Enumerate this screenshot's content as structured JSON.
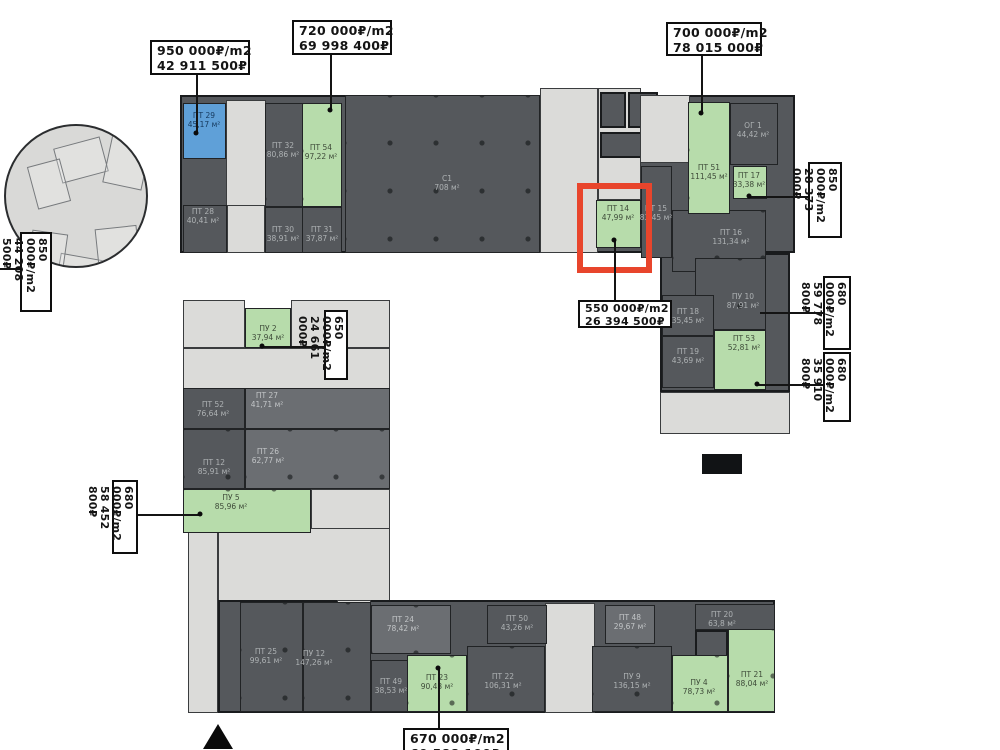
{
  "canvas": {
    "width": 1000,
    "height": 750,
    "background": "#ffffff"
  },
  "palette": {
    "dark": "#55585c",
    "mid": "#6b6e72",
    "light": "#dbdbd9",
    "green": "#b7dcab",
    "blue": "#5fa0d8",
    "red": "#e8452c"
  },
  "units": [
    {
      "name": "ПТ 29",
      "area": "45,17 м²",
      "type": "blue",
      "rect": [
        183,
        103,
        43,
        56
      ],
      "label": [
        204,
        120
      ],
      "dots": false
    },
    {
      "name": "ПТ 32",
      "area": "80,86 м²",
      "type": "dark",
      "rect": [
        265,
        103,
        38,
        104
      ],
      "label": [
        283,
        150
      ],
      "dots": true
    },
    {
      "name": "ПТ 54",
      "area": "97,22 м²",
      "type": "green",
      "rect": [
        302,
        103,
        40,
        104
      ],
      "label": [
        321,
        152
      ],
      "dots": true
    },
    {
      "name": "ПТ 28",
      "area": "40,41 м²",
      "type": "dark",
      "rect": [
        183,
        205,
        44,
        48
      ],
      "label": [
        203,
        216
      ],
      "dots": false
    },
    {
      "name": "ПТ 30",
      "area": "38,91 м²",
      "type": "dark",
      "rect": [
        265,
        207,
        38,
        46
      ],
      "label": [
        283,
        234
      ],
      "dots": false
    },
    {
      "name": "ПТ 31",
      "area": "37,87 м²",
      "type": "dark",
      "rect": [
        302,
        207,
        40,
        46
      ],
      "label": [
        322,
        234
      ],
      "dots": false
    },
    {
      "name": "C1",
      "area": "708 м²",
      "type": "dark",
      "rect": [
        345,
        95,
        195,
        158
      ],
      "label": [
        447,
        183
      ],
      "dots": true
    },
    {
      "name": "ПТ 14",
      "area": "47,99 м²",
      "type": "green",
      "rect": [
        596,
        200,
        45,
        48
      ],
      "label": [
        618,
        213
      ],
      "dots": false
    },
    {
      "name": "ПТ 15",
      "area": "83,45 м²",
      "type": "dark",
      "rect": [
        641,
        166,
        31,
        92
      ],
      "label": [
        656,
        213
      ],
      "dots": false
    },
    {
      "name": "ПТ 16",
      "area": "131,34 м²",
      "type": "dark",
      "rect": [
        672,
        210,
        94,
        62
      ],
      "label": [
        731,
        237
      ],
      "dots": true
    },
    {
      "name": "ОГ 1",
      "area": "44,42 м²",
      "type": "dark",
      "rect": [
        730,
        103,
        48,
        62
      ],
      "label": [
        753,
        130
      ],
      "dots": false
    },
    {
      "name": "ПТ 51",
      "area": "111,45 м²",
      "type": "green",
      "rect": [
        688,
        102,
        42,
        112
      ],
      "label": [
        709,
        172
      ],
      "dots": true
    },
    {
      "name": "ПТ 17",
      "area": "33,38 м²",
      "type": "green",
      "rect": [
        733,
        166,
        34,
        33
      ],
      "label": [
        749,
        180
      ],
      "dots": false
    },
    {
      "name": "ПУ 10",
      "area": "87,91 м²",
      "type": "dark",
      "rect": [
        695,
        258,
        71,
        72
      ],
      "label": [
        743,
        301
      ],
      "dots": true
    },
    {
      "name": "ПТ 18",
      "area": "35,45 м²",
      "type": "dark",
      "rect": [
        662,
        295,
        52,
        41
      ],
      "label": [
        688,
        316
      ],
      "dots": false
    },
    {
      "name": "ПТ 19",
      "area": "43,69 м²",
      "type": "dark",
      "rect": [
        662,
        336,
        52,
        52
      ],
      "label": [
        688,
        356
      ],
      "dots": false
    },
    {
      "name": "ПТ 53",
      "area": "52,81 м²",
      "type": "green",
      "rect": [
        714,
        330,
        52,
        60
      ],
      "label": [
        744,
        343
      ],
      "dots": false
    },
    {
      "name": "ПУ 2",
      "area": "37,94 м²",
      "type": "green",
      "rect": [
        245,
        308,
        46,
        40
      ],
      "label": [
        268,
        333
      ],
      "dots": false
    },
    {
      "name": "ПТ 52",
      "area": "76,64 м²",
      "type": "dark",
      "rect": [
        183,
        388,
        62,
        41
      ],
      "label": [
        213,
        409
      ],
      "dots": false
    },
    {
      "name": "ПТ 27",
      "area": "41,71 м²",
      "type": "mid",
      "rect": [
        245,
        388,
        145,
        41
      ],
      "label": [
        267,
        400
      ],
      "dots": false
    },
    {
      "name": "ПТ 26",
      "area": "62,77 м²",
      "type": "mid",
      "rect": [
        245,
        429,
        145,
        60
      ],
      "label": [
        268,
        456
      ],
      "dots": true
    },
    {
      "name": "ПТ 12",
      "area": "85,91 м²",
      "type": "dark",
      "rect": [
        183,
        429,
        62,
        60
      ],
      "label": [
        214,
        467
      ],
      "dots": true
    },
    {
      "name": "ПУ 5",
      "area": "85,96 м²",
      "type": "green",
      "rect": [
        183,
        489,
        128,
        44
      ],
      "label": [
        231,
        502
      ],
      "dots": true
    },
    {
      "name": "ПТ 25",
      "area": "99,61 м²",
      "type": "dark",
      "rect": [
        240,
        602,
        63,
        110
      ],
      "label": [
        266,
        656
      ],
      "dots": true
    },
    {
      "name": "ПУ 12",
      "area": "147,26 м²",
      "type": "dark",
      "rect": [
        303,
        602,
        68,
        110
      ],
      "label": [
        314,
        658
      ],
      "dots": true
    },
    {
      "name": "ПТ 24",
      "area": "78,42 м²",
      "type": "mid",
      "rect": [
        371,
        605,
        80,
        49
      ],
      "label": [
        403,
        624
      ],
      "dots": true
    },
    {
      "name": "ПТ 49",
      "area": "38,53 м²",
      "type": "dark",
      "rect": [
        371,
        660,
        38,
        52
      ],
      "label": [
        391,
        686
      ],
      "dots": false
    },
    {
      "name": "ПТ 23",
      "area": "90,43 м²",
      "type": "green",
      "rect": [
        407,
        655,
        60,
        57
      ],
      "label": [
        437,
        682
      ],
      "dots": true
    },
    {
      "name": "ПТ 50",
      "area": "43,26 м²",
      "type": "dark",
      "rect": [
        487,
        605,
        60,
        39
      ],
      "label": [
        517,
        623
      ],
      "dots": false
    },
    {
      "name": "ПТ 22",
      "area": "106,31 м²",
      "type": "dark",
      "rect": [
        467,
        646,
        78,
        66
      ],
      "label": [
        503,
        681
      ],
      "dots": true
    },
    {
      "name": "ПТ 48",
      "area": "29,67 м²",
      "type": "mid",
      "rect": [
        605,
        605,
        50,
        39
      ],
      "label": [
        630,
        622
      ],
      "dots": false
    },
    {
      "name": "ПУ 9",
      "area": "136,15 м²",
      "type": "dark",
      "rect": [
        592,
        646,
        80,
        66
      ],
      "label": [
        632,
        681
      ],
      "dots": true
    },
    {
      "name": "ПУ 4",
      "area": "78,73 м²",
      "type": "green",
      "rect": [
        672,
        655,
        56,
        57
      ],
      "label": [
        699,
        687
      ],
      "dots": true
    },
    {
      "name": "ПТ 21",
      "area": "88,04 м²",
      "type": "green",
      "rect": [
        728,
        628,
        47,
        84
      ],
      "label": [
        752,
        679
      ],
      "dots": true
    },
    {
      "name": "ПТ 20",
      "area": "63,8 м²",
      "type": "dark",
      "rect": [
        695,
        604,
        80,
        26
      ],
      "label": [
        722,
        619
      ],
      "dots": false
    }
  ],
  "structures": [
    {
      "type": "dark",
      "rect": [
        180,
        95,
        615,
        158
      ]
    },
    {
      "type": "dark",
      "rect": [
        660,
        253,
        130,
        139
      ]
    },
    {
      "type": "light",
      "rect": [
        660,
        392,
        130,
        42
      ]
    },
    {
      "type": "light",
      "rect": [
        226,
        100,
        40,
        153
      ]
    },
    {
      "type": "light",
      "rect": [
        227,
        205,
        38,
        48
      ]
    },
    {
      "type": "light",
      "rect": [
        540,
        88,
        58,
        165
      ]
    },
    {
      "type": "light",
      "rect": [
        598,
        88,
        43,
        112
      ]
    },
    {
      "type": "dark",
      "rect": [
        600,
        92,
        26,
        36
      ]
    },
    {
      "type": "dark",
      "rect": [
        628,
        92,
        30,
        36
      ]
    },
    {
      "type": "dark",
      "rect": [
        600,
        132,
        56,
        26
      ]
    },
    {
      "type": "light",
      "rect": [
        640,
        95,
        50,
        68
      ]
    },
    {
      "type": "light",
      "rect": [
        183,
        300,
        62,
        48
      ]
    },
    {
      "type": "light",
      "rect": [
        291,
        300,
        99,
        48
      ]
    },
    {
      "type": "light",
      "rect": [
        183,
        348,
        207,
        42
      ]
    },
    {
      "type": "dark",
      "rect": [
        183,
        388,
        207,
        101
      ]
    },
    {
      "type": "light",
      "rect": [
        311,
        489,
        79,
        46
      ]
    },
    {
      "type": "light",
      "rect": [
        218,
        528,
        172,
        74
      ]
    },
    {
      "type": "light",
      "rect": [
        188,
        528,
        30,
        185
      ]
    },
    {
      "type": "dark",
      "rect": [
        218,
        600,
        557,
        113
      ]
    },
    {
      "type": "light",
      "rect": [
        545,
        603,
        50,
        110
      ]
    },
    {
      "type": "light",
      "rect": [
        337,
        600,
        34,
        36
      ]
    },
    {
      "type": "dark",
      "rect": [
        695,
        630,
        33,
        30
      ]
    }
  ],
  "callouts": [
    {
      "line1": "950 000₽/m2",
      "line2": "42 911 500₽",
      "rect": [
        150,
        40,
        100,
        35
      ],
      "orient": "h",
      "connectors": [
        [
          196,
          75,
          196,
          133
        ]
      ],
      "dot": [
        196,
        133
      ]
    },
    {
      "line1": "720 000₽/m2",
      "line2": "69 998 400₽",
      "rect": [
        292,
        20,
        100,
        35
      ],
      "orient": "h",
      "connectors": [
        [
          330,
          55,
          330,
          110
        ]
      ],
      "dot": [
        330,
        110
      ]
    },
    {
      "line1": "700 000₽/m2",
      "line2": "78 015 000₽",
      "rect": [
        666,
        22,
        96,
        34
      ],
      "orient": "h",
      "connectors": [
        [
          701,
          56,
          701,
          113
        ]
      ],
      "dot": [
        701,
        113
      ]
    },
    {
      "line1": "850 000₽/m2",
      "line2": "28 373 000₽",
      "rect": [
        808,
        162,
        34,
        76
      ],
      "orient": "v",
      "connectors": [
        [
          749,
          196,
          808,
          196
        ]
      ],
      "dot": [
        749,
        196
      ]
    },
    {
      "line1": "680 000₽/m2",
      "line2": "59 778 800₽",
      "rect": [
        823,
        276,
        28,
        74
      ],
      "orient": "v",
      "connectors": [
        [
          760,
          312,
          823,
          312
        ]
      ],
      "dot": null
    },
    {
      "line1": "680 000₽/m2",
      "line2": "35 910 800₽",
      "rect": [
        823,
        352,
        28,
        70
      ],
      "orient": "v",
      "connectors": [
        [
          757,
          384,
          823,
          384
        ]
      ],
      "dot": [
        757,
        384
      ]
    },
    {
      "line1": "850 000₽/m2",
      "line2": "44 208 500₽",
      "rect": [
        20,
        232,
        32,
        80
      ],
      "orient": "v",
      "connectors": [
        [
          0,
          268,
          20,
          268
        ]
      ],
      "dot": null
    },
    {
      "line1": "650 000₽/m2",
      "line2": "24 661 000₽",
      "rect": [
        324,
        310,
        24,
        70
      ],
      "orient": "v",
      "connectors": [
        [
          262,
          346,
          324,
          346
        ]
      ],
      "dot": [
        262,
        346
      ]
    },
    {
      "line1": "680 000₽/m2",
      "line2": "58 452 800₽",
      "rect": [
        112,
        480,
        26,
        74
      ],
      "orient": "v",
      "connectors": [
        [
          138,
          514,
          200,
          514
        ]
      ],
      "dot": [
        200,
        514
      ]
    },
    {
      "line1": "670 000₽/m2",
      "line2": "60 588 100₽",
      "rect": [
        403,
        728,
        106,
        36
      ],
      "orient": "h",
      "connectors": [
        [
          438,
          668,
          438,
          728
        ]
      ],
      "dot": [
        438,
        668
      ]
    },
    {
      "line1": "550 000₽/m2",
      "line2": "26 394 500₽",
      "rect": [
        578,
        300,
        94,
        28
      ],
      "orient": "h",
      "small": true,
      "connectors": [
        [
          614,
          240,
          614,
          300
        ]
      ],
      "dot": [
        614,
        240
      ]
    }
  ],
  "highlight": {
    "rect": [
      577,
      183,
      75,
      90
    ]
  },
  "shaft": {
    "rect": [
      702,
      454,
      40,
      20
    ]
  },
  "north_arrow": {
    "x": 203,
    "y": 724
  },
  "inset": {
    "rect": [
      4,
      124,
      144,
      144
    ],
    "shapes": [
      {
        "rect": [
          51,
          16,
          48,
          36
        ],
        "rot": -15
      },
      {
        "rect": [
          101,
          11,
          40,
          50
        ],
        "rot": 12
      },
      {
        "rect": [
          26,
          36,
          34,
          44
        ],
        "rot": -15
      },
      {
        "rect": [
          51,
          131,
          52,
          40
        ],
        "rot": 10
      },
      {
        "rect": [
          91,
          101,
          42,
          48
        ],
        "rot": -6
      },
      {
        "rect": [
          24,
          106,
          36,
          34
        ],
        "rot": 8
      }
    ]
  }
}
